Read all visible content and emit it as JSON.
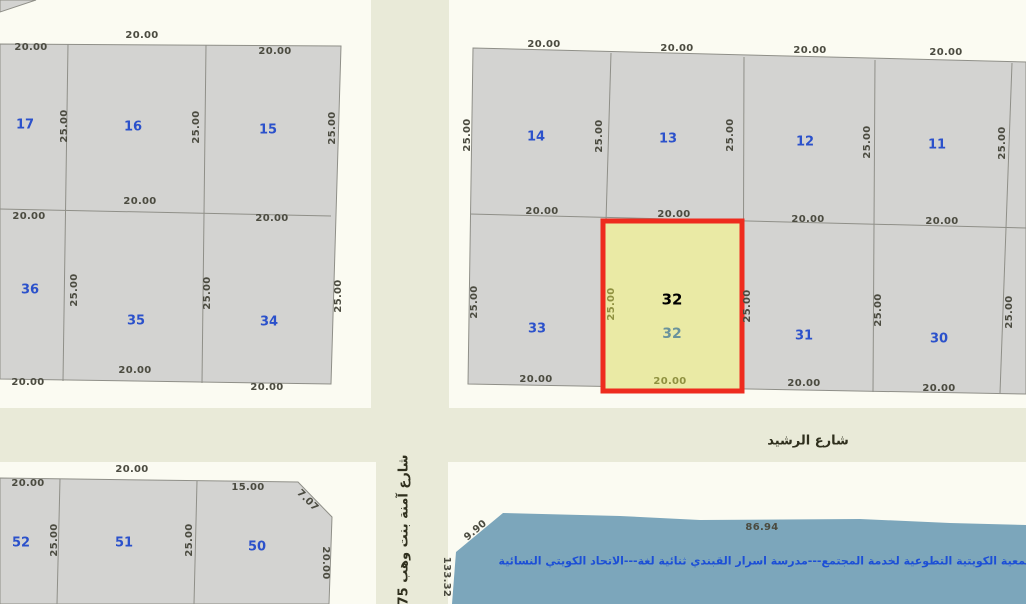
{
  "map_title": "cadastral-parcel-map",
  "highlighted_parcel": {
    "number": "32",
    "frontage": "20.00",
    "depth": "25.00"
  },
  "street_names": [
    "شارع الرشيد",
    "شارع آمنة بنت وهب 75"
  ],
  "facility_text": "الجمعية الكويتية التطوعية لخدمة المجتمع---مدرسة اسرار القبندي ثنائية لغة---الاتحاد الكويتي النسائية",
  "colors": {
    "highlight_border": "#EE2B1E",
    "highlight_fill": "#EAEAA5",
    "parcel_fill": "#D3D3D1",
    "road_fill": "#E9EAD8",
    "buffer_fill": "#FBFBF2",
    "facility_fill": "#7CA6BB",
    "parcel_number_text": "#2B51CB",
    "dimension_text": "#4B4B40",
    "highlight_dimension_text": "#8F9140",
    "facility_text_color": "#1C4FD6"
  },
  "labels": [
    {
      "t": "20.00",
      "x": 31,
      "y": 48,
      "type": "dim"
    },
    {
      "t": "20.00",
      "x": 142,
      "y": 36,
      "type": "dim"
    },
    {
      "t": "20.00",
      "x": 275,
      "y": 52,
      "type": "dim"
    },
    {
      "t": "25.00",
      "x": 65,
      "y": 126,
      "r": -90,
      "type": "dim"
    },
    {
      "t": "25.00",
      "x": 197,
      "y": 127,
      "r": -90,
      "type": "dim"
    },
    {
      "t": "25.00",
      "x": 333,
      "y": 128,
      "r": -90,
      "type": "dim"
    },
    {
      "t": "17",
      "x": 25,
      "y": 125,
      "type": "parcel"
    },
    {
      "t": "16",
      "x": 133,
      "y": 127,
      "type": "parcel"
    },
    {
      "t": "15",
      "x": 268,
      "y": 130,
      "type": "parcel"
    },
    {
      "t": "20.00",
      "x": 140,
      "y": 202,
      "type": "dim"
    },
    {
      "t": "20.00",
      "x": 29,
      "y": 217,
      "type": "dim"
    },
    {
      "t": "20.00",
      "x": 272,
      "y": 219,
      "type": "dim"
    },
    {
      "t": "25.00",
      "x": 75,
      "y": 290,
      "r": -90,
      "type": "dim"
    },
    {
      "t": "25.00",
      "x": 208,
      "y": 293,
      "r": -90,
      "type": "dim"
    },
    {
      "t": "25.00",
      "x": 339,
      "y": 296,
      "r": -90,
      "type": "dim"
    },
    {
      "t": "36",
      "x": 30,
      "y": 290,
      "type": "parcel"
    },
    {
      "t": "35",
      "x": 136,
      "y": 321,
      "type": "parcel"
    },
    {
      "t": "34",
      "x": 269,
      "y": 322,
      "type": "parcel"
    },
    {
      "t": "20.00",
      "x": 135,
      "y": 371,
      "type": "dim"
    },
    {
      "t": "20.00",
      "x": 28,
      "y": 383,
      "type": "dim"
    },
    {
      "t": "20.00",
      "x": 267,
      "y": 388,
      "type": "dim"
    },
    {
      "t": "20.00",
      "x": 544,
      "y": 45,
      "type": "dim"
    },
    {
      "t": "20.00",
      "x": 677,
      "y": 49,
      "type": "dim"
    },
    {
      "t": "20.00",
      "x": 810,
      "y": 51,
      "type": "dim"
    },
    {
      "t": "20.00",
      "x": 946,
      "y": 53,
      "type": "dim"
    },
    {
      "t": "25.00",
      "x": 468,
      "y": 135,
      "r": -90,
      "type": "dim"
    },
    {
      "t": "25.00",
      "x": 600,
      "y": 136,
      "r": -90,
      "type": "dim"
    },
    {
      "t": "25.00",
      "x": 731,
      "y": 135,
      "r": -90,
      "type": "dim"
    },
    {
      "t": "25.00",
      "x": 868,
      "y": 142,
      "r": -90,
      "type": "dim"
    },
    {
      "t": "25.00",
      "x": 1003,
      "y": 143,
      "r": -90,
      "type": "dim"
    },
    {
      "t": "14",
      "x": 536,
      "y": 137,
      "type": "parcel"
    },
    {
      "t": "13",
      "x": 668,
      "y": 139,
      "type": "parcel"
    },
    {
      "t": "12",
      "x": 805,
      "y": 142,
      "type": "parcel"
    },
    {
      "t": "11",
      "x": 937,
      "y": 145,
      "type": "parcel"
    },
    {
      "t": "20.00",
      "x": 542,
      "y": 212,
      "type": "dim"
    },
    {
      "t": "20.00",
      "x": 674,
      "y": 215,
      "type": "dim"
    },
    {
      "t": "20.00",
      "x": 808,
      "y": 220,
      "type": "dim"
    },
    {
      "t": "20.00",
      "x": 942,
      "y": 222,
      "type": "dim"
    },
    {
      "t": "25.00",
      "x": 475,
      "y": 302,
      "r": -90,
      "type": "dim"
    },
    {
      "t": "25.00",
      "x": 612,
      "y": 304,
      "r": -90,
      "type": "dim-olive"
    },
    {
      "t": "25.00",
      "x": 748,
      "y": 306,
      "r": -90,
      "type": "dim"
    },
    {
      "t": "25.00",
      "x": 879,
      "y": 310,
      "r": -90,
      "type": "dim"
    },
    {
      "t": "25.00",
      "x": 1010,
      "y": 312,
      "r": -90,
      "type": "dim"
    },
    {
      "t": "33",
      "x": 537,
      "y": 329,
      "type": "parcel"
    },
    {
      "t": "32",
      "x": 672,
      "y": 300,
      "type": "sel"
    },
    {
      "t": "32",
      "x": 672,
      "y": 334,
      "type": "sel2"
    },
    {
      "t": "31",
      "x": 804,
      "y": 336,
      "type": "parcel"
    },
    {
      "t": "30",
      "x": 939,
      "y": 339,
      "type": "parcel"
    },
    {
      "t": "20.00",
      "x": 536,
      "y": 380,
      "type": "dim"
    },
    {
      "t": "20.00",
      "x": 670,
      "y": 382,
      "type": "dim-olive"
    },
    {
      "t": "20.00",
      "x": 804,
      "y": 384,
      "type": "dim"
    },
    {
      "t": "20.00",
      "x": 939,
      "y": 389,
      "type": "dim"
    },
    {
      "t": "20.00",
      "x": 132,
      "y": 470,
      "type": "dim"
    },
    {
      "t": "20.00",
      "x": 28,
      "y": 484,
      "type": "dim"
    },
    {
      "t": "15.00",
      "x": 248,
      "y": 488,
      "type": "dim"
    },
    {
      "t": "7.07",
      "x": 307,
      "y": 501,
      "r": 45,
      "type": "dim"
    },
    {
      "t": "25.00",
      "x": 55,
      "y": 540,
      "r": -90,
      "type": "dim"
    },
    {
      "t": "25.00",
      "x": 190,
      "y": 540,
      "r": -90,
      "type": "dim"
    },
    {
      "t": "20.00",
      "x": 325,
      "y": 563,
      "r": 90,
      "type": "dim"
    },
    {
      "t": "52",
      "x": 21,
      "y": 543,
      "type": "parcel"
    },
    {
      "t": "51",
      "x": 124,
      "y": 543,
      "type": "parcel"
    },
    {
      "t": "50",
      "x": 257,
      "y": 547,
      "type": "parcel"
    },
    {
      "t": "شارع الرشيد",
      "x": 808,
      "y": 441,
      "type": "street"
    },
    {
      "t": "شارع آمنة بنت وهب 75",
      "x": 404,
      "y": 530,
      "r": -90,
      "type": "street"
    },
    {
      "t": "133.32",
      "x": 446,
      "y": 577,
      "r": 90,
      "type": "dim"
    },
    {
      "t": "9.90",
      "x": 476,
      "y": 531,
      "r": -40,
      "type": "dim"
    },
    {
      "t": "86.94",
      "x": 762,
      "y": 528,
      "type": "dim"
    },
    {
      "t": "الجمعية الكويتية التطوعية لخدمة المجتمع---مدرسة اسرار القبندي ثنائية لغة---الاتحاد الكويتي النسائية",
      "x": 770,
      "y": 561,
      "type": "info"
    }
  ]
}
